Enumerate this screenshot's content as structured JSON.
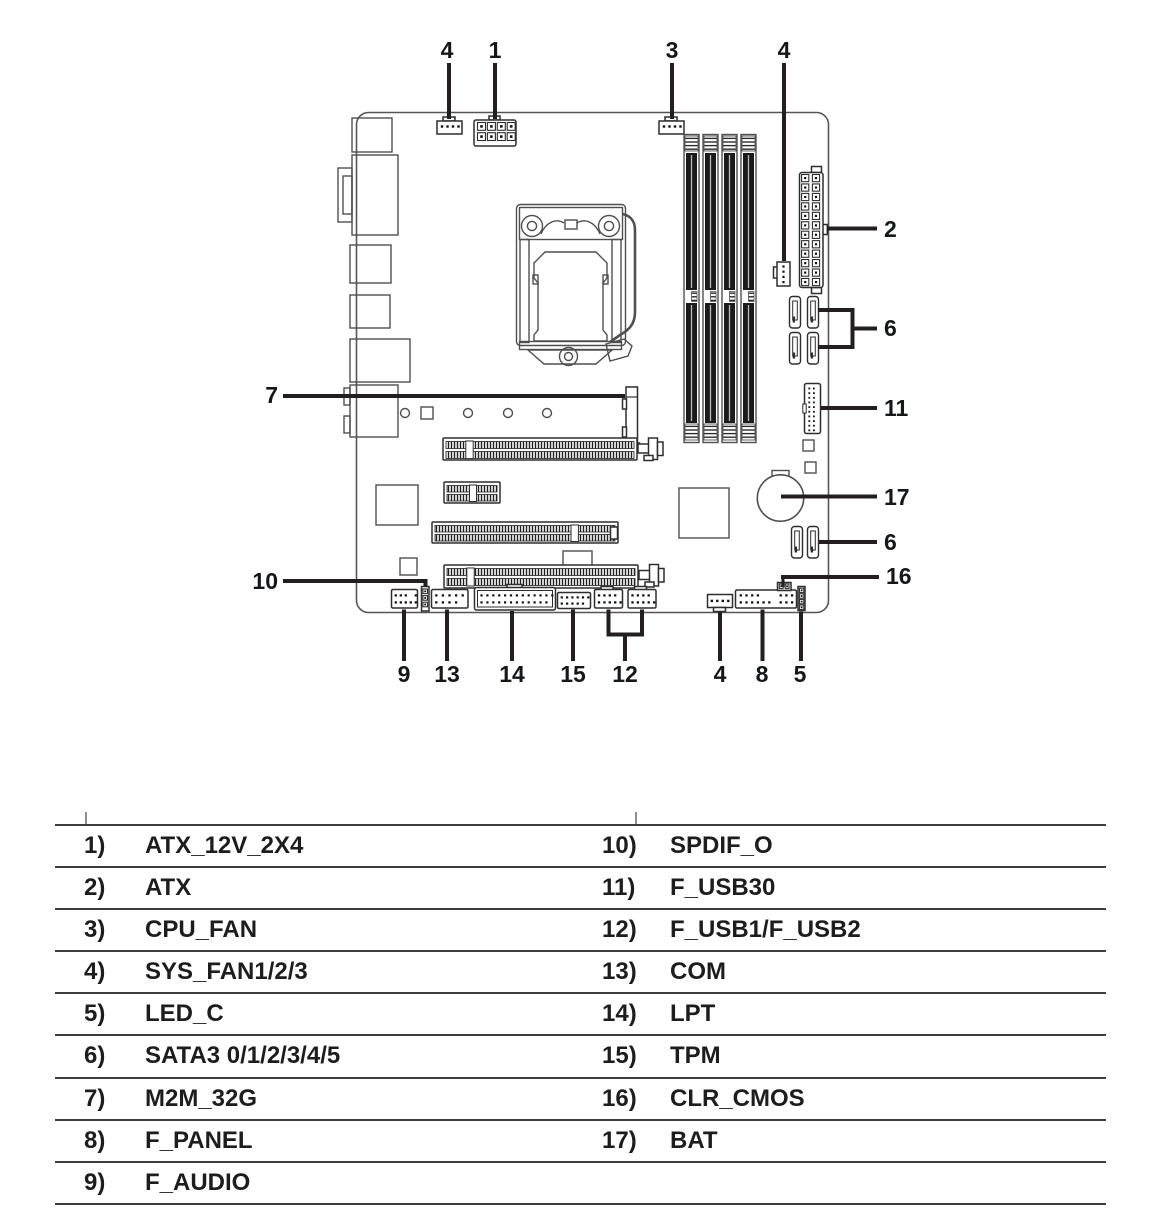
{
  "figure": {
    "type": "motherboard-connector-location-diagram",
    "callouts": [
      {
        "label": "4",
        "target": "SYS_FAN1"
      },
      {
        "label": "1",
        "target": "ATX_12V_2X4"
      },
      {
        "label": "3",
        "target": "CPU_FAN"
      },
      {
        "label": "4",
        "target": "SYS_FAN3"
      },
      {
        "label": "2",
        "target": "ATX"
      },
      {
        "label": "6",
        "target": "SATA3 upper ports"
      },
      {
        "label": "11",
        "target": "F_USB30"
      },
      {
        "label": "17",
        "target": "BAT"
      },
      {
        "label": "6",
        "target": "SATA3 lower ports"
      },
      {
        "label": "16",
        "target": "CLR_CMOS"
      },
      {
        "label": "7",
        "target": "M2M_32G"
      },
      {
        "label": "10",
        "target": "SPDIF_O"
      },
      {
        "label": "9",
        "target": "F_AUDIO"
      },
      {
        "label": "13",
        "target": "COM"
      },
      {
        "label": "14",
        "target": "LPT"
      },
      {
        "label": "15",
        "target": "TPM"
      },
      {
        "label": "12",
        "target": "F_USB1/F_USB2"
      },
      {
        "label": "4",
        "target": "SYS_FAN2"
      },
      {
        "label": "8",
        "target": "F_PANEL"
      },
      {
        "label": "5",
        "target": "LED_C"
      }
    ]
  },
  "legend": {
    "rows": [
      {
        "left_num": "1)",
        "left_label": "ATX_12V_2X4",
        "right_num": "10)",
        "right_label": "SPDIF_O"
      },
      {
        "left_num": "2)",
        "left_label": "ATX",
        "right_num": "11)",
        "right_label": "F_USB30"
      },
      {
        "left_num": "3)",
        "left_label": "CPU_FAN",
        "right_num": "12)",
        "right_label": "F_USB1/F_USB2"
      },
      {
        "left_num": "4)",
        "left_label": "SYS_FAN1/2/3",
        "right_num": "13)",
        "right_label": "COM"
      },
      {
        "left_num": "5)",
        "left_label": "LED_C",
        "right_num": "14)",
        "right_label": "LPT"
      },
      {
        "left_num": "6)",
        "left_label": "SATA3 0/1/2/3/4/5",
        "right_num": "15)",
        "right_label": "TPM"
      },
      {
        "left_num": "7)",
        "left_label": "M2M_32G",
        "right_num": "16)",
        "right_label": "CLR_CMOS"
      },
      {
        "left_num": "8)",
        "left_label": "F_PANEL",
        "right_num": "17)",
        "right_label": "BAT"
      },
      {
        "left_num": "9)",
        "left_label": "F_AUDIO",
        "right_num": "",
        "right_label": ""
      }
    ]
  },
  "colors": {
    "line_art": "#4f4f4f",
    "connector_stroke": "#2e2e2e",
    "slot_fill": "#1b1b1b",
    "leader": "#231f20",
    "table_rule": "#3c3c3c",
    "text": "#1d1d1d"
  }
}
